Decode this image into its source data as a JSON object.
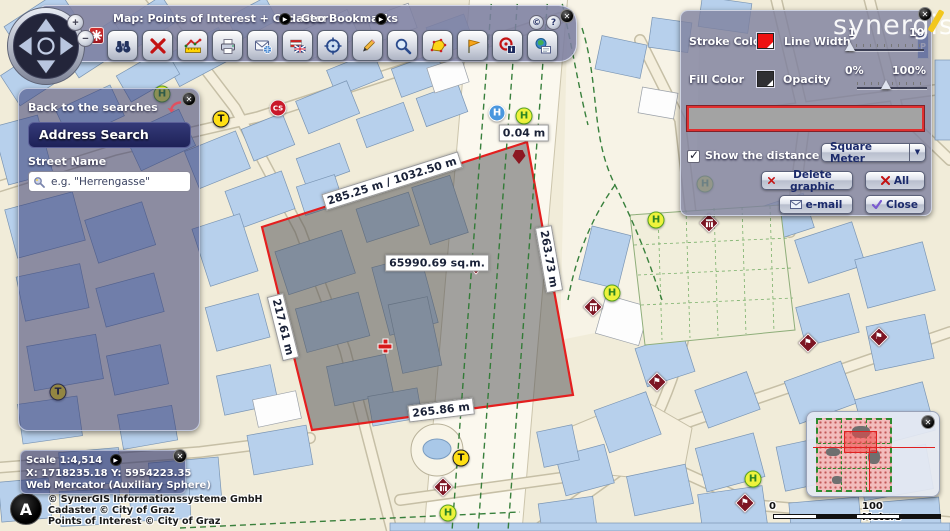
{
  "toolbar": {
    "map_title": "Map: Points of Interest + Cadaster",
    "bookmarks_label": "Geo Bookmarks",
    "copyright_symbol": "©",
    "help_symbol": "?",
    "icons": [
      "binoculars-search",
      "delete-redlining",
      "measure-distance",
      "print",
      "send-map-email",
      "language-flags",
      "center-map",
      "draw-pencil",
      "zoom-magnifier",
      "measure-area",
      "bookmark-flag",
      "identify-info",
      "map-info-form"
    ]
  },
  "zoom_controls": {
    "zoom_in": "+",
    "zoom_out": "−"
  },
  "address_panel": {
    "back_label": "Back to the searches",
    "title": "Address Search",
    "field_label": "Street Name",
    "input_value": "e.g. \"Herrengasse\""
  },
  "draw_panel": {
    "stroke_color_label": "Stroke Color",
    "line_width_label": "Line Width",
    "line_width_min": "1",
    "line_width_max": "10",
    "fill_color_label": "Fill Color",
    "opacity_label": "Opacity",
    "opacity_min": "0%",
    "opacity_max": "100%",
    "stroke_color": "#ee1111",
    "fill_color": "#2f2f33",
    "show_distance_label": "Show the distance",
    "show_distance_checked": "checked",
    "unit_selected": "Square Meter",
    "delete_graphic_label": "Delete graphic",
    "all_label": "All",
    "email_label": "e-mail",
    "close_label": "Close"
  },
  "watermark": "synergis",
  "status_panel": {
    "scale": "Scale 1:4,514",
    "coordinates": "X: 1718235.18 Y: 5954223.35",
    "projection": "Web Mercator (Auxiliary Sphere)"
  },
  "attribution": [
    "© SynerGIS Informationssysteme GmbH",
    "Cadaster © City of Graz",
    "Points of Interest © City of Graz"
  ],
  "north_logo_letter": "A",
  "scalebar": {
    "start": "0",
    "end": "100 Meters"
  },
  "map": {
    "parking_sign": "P",
    "measure_labels": [
      {
        "text": "285.25 m / 1032.50 m",
        "x": 392,
        "y": 181,
        "rot": -17.5
      },
      {
        "text": "263.73 m",
        "x": 549,
        "y": 259,
        "rot": 80
      },
      {
        "text": "217.61 m",
        "x": 283,
        "y": 327,
        "rot": 76
      },
      {
        "text": "265.86 m",
        "x": 441,
        "y": 410,
        "rot": -7
      },
      {
        "text": "65990.69 sq.m.",
        "x": 437,
        "y": 263,
        "rot": 0
      },
      {
        "text": "0.04 m",
        "x": 524,
        "y": 133,
        "rot": 0
      }
    ],
    "pois": [
      {
        "type": "tram",
        "label": "T",
        "x": 221,
        "y": 119
      },
      {
        "type": "tram",
        "label": "T",
        "x": 58,
        "y": 392
      },
      {
        "type": "tram",
        "label": "T",
        "x": 461,
        "y": 458
      },
      {
        "type": "carshare",
        "label": "CS",
        "x": 278,
        "y": 108
      },
      {
        "type": "hospital",
        "label": "H",
        "x": 497,
        "y": 113
      },
      {
        "type": "busstop",
        "label": "H",
        "x": 524,
        "y": 116
      },
      {
        "type": "busstop",
        "label": "H",
        "x": 162,
        "y": 94
      },
      {
        "type": "busstop",
        "label": "H",
        "x": 656,
        "y": 220
      },
      {
        "type": "busstop",
        "label": "H",
        "x": 612,
        "y": 293
      },
      {
        "type": "busstop",
        "label": "H",
        "x": 705,
        "y": 184
      },
      {
        "type": "busstop",
        "label": "H",
        "x": 753,
        "y": 479
      },
      {
        "type": "busstop",
        "label": "H",
        "x": 448,
        "y": 513
      },
      {
        "type": "museum",
        "x": 709,
        "y": 223
      },
      {
        "type": "museum",
        "x": 593,
        "y": 307
      },
      {
        "type": "museum",
        "x": 443,
        "y": 487
      },
      {
        "type": "flag",
        "x": 879,
        "y": 337
      },
      {
        "type": "flag",
        "x": 808,
        "y": 343
      },
      {
        "type": "flag",
        "x": 657,
        "y": 382
      },
      {
        "type": "flag",
        "x": 745,
        "y": 503
      },
      {
        "type": "cross",
        "x": 385,
        "y": 346
      },
      {
        "type": "marker-pentagon",
        "x": 519,
        "y": 157
      },
      {
        "type": "marker-diamond",
        "x": 476,
        "y": 267
      }
    ]
  }
}
